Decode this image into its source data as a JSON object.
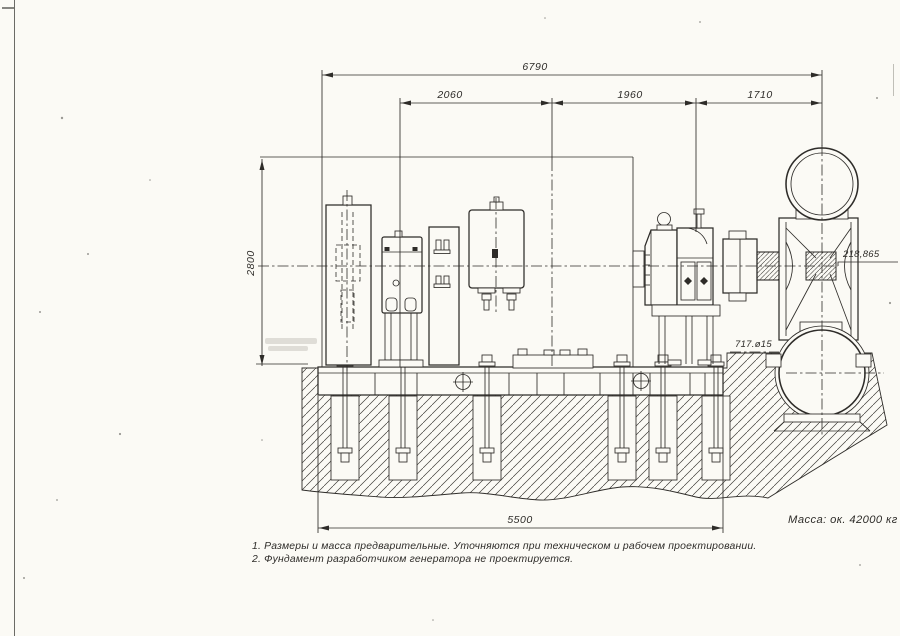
{
  "drawing": {
    "dims": {
      "overall_length": "6790",
      "section_a": "2060",
      "section_b": "1960",
      "section_c": "1710",
      "height": "2800",
      "foundation_length": "5500"
    },
    "labels": {
      "shaft_axis_elevation": "218,865",
      "foundation_detail": "717.ø15"
    },
    "mass_note": "Масса: ок. 42000 кг",
    "notes": {
      "note1": "1. Размеры и масса предварительные. Уточняются при техническом и рабочем проектировании.",
      "note2": "2. Фундамент разработчиком генератора не проектируется."
    },
    "colors": {
      "ink": "#2e2c29",
      "paper": "#fbfaf5"
    }
  }
}
